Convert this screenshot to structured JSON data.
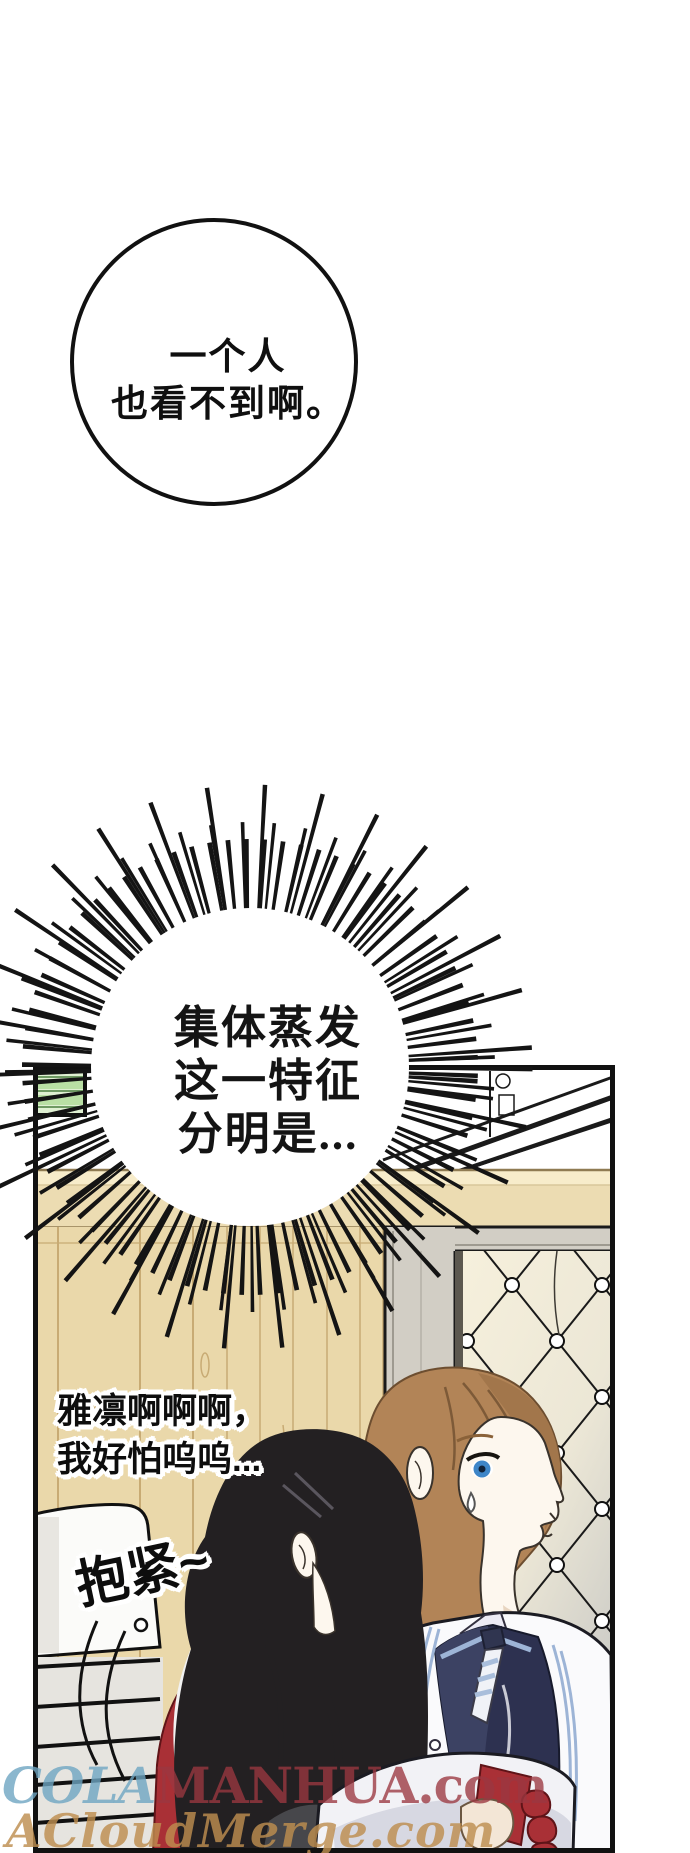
{
  "page": {
    "width": 690,
    "height": 1853,
    "background": "#ffffff"
  },
  "speech_bubbles": {
    "round_bubble": {
      "line1": "一个人",
      "line2": "也看不到啊。"
    },
    "burst_bubble": {
      "line1": "集体蒸发",
      "line2": "这一特征",
      "line3": "分明是..."
    }
  },
  "dialogue": {
    "scared_line1": "雅凛啊啊啊，",
    "scared_line2": "我好怕呜呜...",
    "hug_line": "抱紧~"
  },
  "watermarks": {
    "site1_prefix": "COLA",
    "site1_suffix": "MANHUA.com",
    "site2": "ACloudMerge.com"
  },
  "colors": {
    "ink": "#111111",
    "wood_wall": "#ead8aa",
    "wood_line": "#c8ab74",
    "molding_light": "#f7ecca",
    "door_frame": "#d2cec5",
    "tuft_light": "#f6f0dc",
    "tuft_shadow": "#c9c9c5",
    "green_window": "#b9dfa4",
    "hair_black": "#232022",
    "hair_brown": "#b28457",
    "skin": "#fdf7ee",
    "eye_blue": "#3e86c8",
    "jacket_red": "#a93036",
    "vest_navy": "#2d3150",
    "uniform_trim": "#9db4d6",
    "watermark_teal": "#6ea5c2",
    "watermark_red": "#9b3740",
    "watermark_tan": "#bd8d4f"
  }
}
